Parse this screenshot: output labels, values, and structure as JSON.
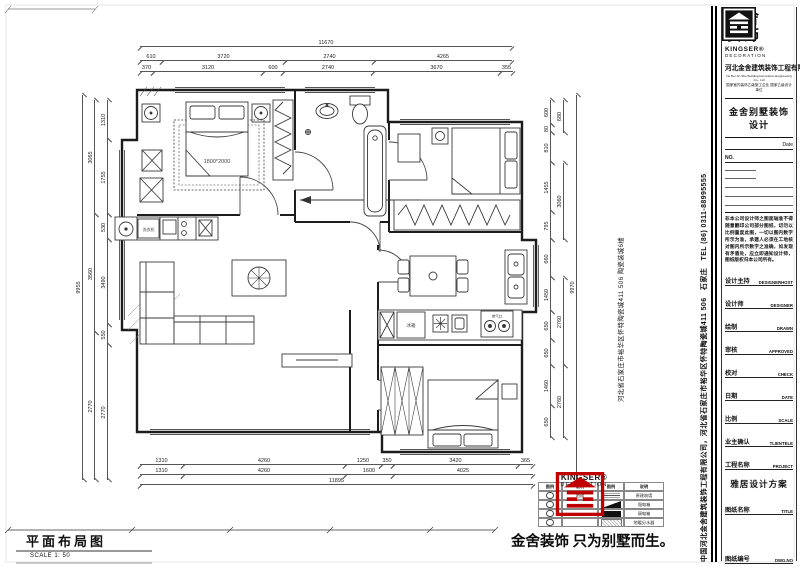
{
  "brand": {
    "cn1": "金舍",
    "cn2": "装饰",
    "latin": "KINGSER®",
    "latin_sub": "DECORATION"
  },
  "titleblock": {
    "company": "河北金舍建筑装饰工程有限公司",
    "company_en": "He Bei Jin She Building Decoration Engineering Co., Ltd",
    "credential": "国家室内装饰乙级施工企业 国家乙级设计单位",
    "product": "金舍别墅装饰设计",
    "date_label": "Date",
    "no_label": "NO.",
    "disclaimer": "非本公司设计师之图面轴准不得随意翻印公司部分图纸，切勿以比例量度此图，一切以图内数字所示为准，承建人必须在工地核对图内所示数字之准确，如发现有矛盾处，应立即通知设计师，图纸版权归本公司所有。",
    "fields": [
      {
        "cn": "设计主持",
        "en": "DESIGNERHOST"
      },
      {
        "cn": "设计师",
        "en": "DESIGNER"
      },
      {
        "cn": "绘制",
        "en": "DRAWN"
      },
      {
        "cn": "审核",
        "en": "APPROVED"
      },
      {
        "cn": "校对",
        "en": "CHECK"
      },
      {
        "cn": "日期",
        "en": "DATE"
      },
      {
        "cn": "比例",
        "en": "SCALE"
      },
      {
        "cn": "业主确认",
        "en": "TLIENTELE"
      },
      {
        "cn": "工程名称",
        "en": "PROJECT"
      },
      {
        "cn": "图纸名称",
        "en": "TITLE"
      },
      {
        "cn": "图纸编号",
        "en": "DWG.NO"
      }
    ],
    "project_value": "雅居设计方案",
    "dwg_value": "ZS-10"
  },
  "strips": {
    "main": "中国河北金舍建筑装饰工程有限公司，河北省石家庄市裕华区怀特陶瓷城411 506　石家庄　TEL (86) 0311-88995555",
    "secondary": "河北省石家庄市裕华区怀特陶瓷城411 506 陶瓷装城6楼"
  },
  "plan": {
    "bed_label": "1800*2000",
    "washer_label": "洗衣机",
    "fridge_label": "冰箱",
    "stove_label": "燃气灶"
  },
  "footer": {
    "plan_title": "平面布局图",
    "scale": "SCALE 1: 50",
    "slogan": "金舍装饰 只为别墅而生。"
  },
  "colors": {
    "accent_red": "#c00000",
    "line": "#1c1c1c"
  },
  "legend": {
    "left": {
      "headers": [
        "图例",
        "说明"
      ],
      "rows": [
        {
          "sym": "socket",
          "label": "地插"
        },
        {
          "sym": "socket",
          "label": ""
        },
        {
          "sym": "socket",
          "label": ""
        },
        {
          "sym": "socket",
          "label": ""
        }
      ]
    },
    "right": {
      "headers": [
        "图例",
        "说明"
      ],
      "rows": [
        {
          "sym": "wall",
          "label": "原建筑墙"
        },
        {
          "sym": "wedge",
          "label": "强电箱"
        },
        {
          "sym": "bar",
          "label": "弱电箱"
        },
        {
          "sym": "hatch",
          "label": "地暖分水器"
        }
      ]
    }
  },
  "dims": {
    "h": [
      [
        "11670",
        140,
        40,
        372
      ],
      [
        "610",
        140,
        54,
        22
      ],
      [
        "3720",
        162,
        54,
        123
      ],
      [
        "2740",
        285,
        54,
        89
      ],
      [
        "4265",
        374,
        54,
        138
      ],
      [
        "370",
        140,
        65,
        13
      ],
      [
        "3120",
        153,
        65,
        110
      ],
      [
        "600",
        263,
        65,
        20
      ],
      [
        "2740",
        283,
        65,
        90
      ],
      [
        "3670",
        373,
        65,
        127
      ],
      [
        "355",
        500,
        65,
        13
      ],
      [
        "1310",
        140,
        458,
        43
      ],
      [
        "4260",
        183,
        458,
        162
      ],
      [
        "1250",
        345,
        458,
        36
      ],
      [
        "350",
        381,
        458,
        12
      ],
      [
        "3420",
        393,
        458,
        125
      ],
      [
        "365",
        518,
        458,
        15
      ],
      [
        "1310",
        140,
        468,
        43
      ],
      [
        "4260",
        183,
        468,
        162
      ],
      [
        "1600",
        345,
        468,
        48
      ],
      [
        "4025",
        393,
        468,
        140
      ],
      [
        "11895",
        140,
        478,
        393
      ]
    ],
    "v": [
      [
        "9955",
        83,
        480,
        385
      ],
      [
        "3065",
        95,
        215,
        115
      ],
      [
        "3560",
        95,
        333,
        118
      ],
      [
        "2770",
        95,
        480,
        147
      ],
      [
        "1310",
        108,
        140,
        40
      ],
      [
        "1755",
        108,
        215,
        75
      ],
      [
        "530",
        108,
        240,
        25
      ],
      [
        "3490",
        108,
        325,
        85
      ],
      [
        "550",
        108,
        345,
        20
      ],
      [
        "2770",
        108,
        480,
        135
      ],
      [
        "9970",
        577,
        480,
        385
      ],
      [
        "680",
        564,
        133,
        33
      ],
      [
        "3060",
        564,
        240,
        77
      ],
      [
        "2760",
        564,
        366,
        88
      ],
      [
        "2760",
        564,
        438,
        72
      ],
      [
        "600",
        551,
        125,
        25
      ],
      [
        "80",
        551,
        133,
        8
      ],
      [
        "810",
        551,
        163,
        30
      ],
      [
        "1455",
        551,
        212,
        49
      ],
      [
        "795",
        551,
        240,
        28
      ],
      [
        "660",
        551,
        278,
        38
      ],
      [
        "1450",
        551,
        312,
        34
      ],
      [
        "650",
        551,
        340,
        28
      ],
      [
        "650",
        551,
        366,
        26
      ],
      [
        "1460",
        551,
        406,
        40
      ],
      [
        "650",
        551,
        438,
        32
      ]
    ]
  }
}
